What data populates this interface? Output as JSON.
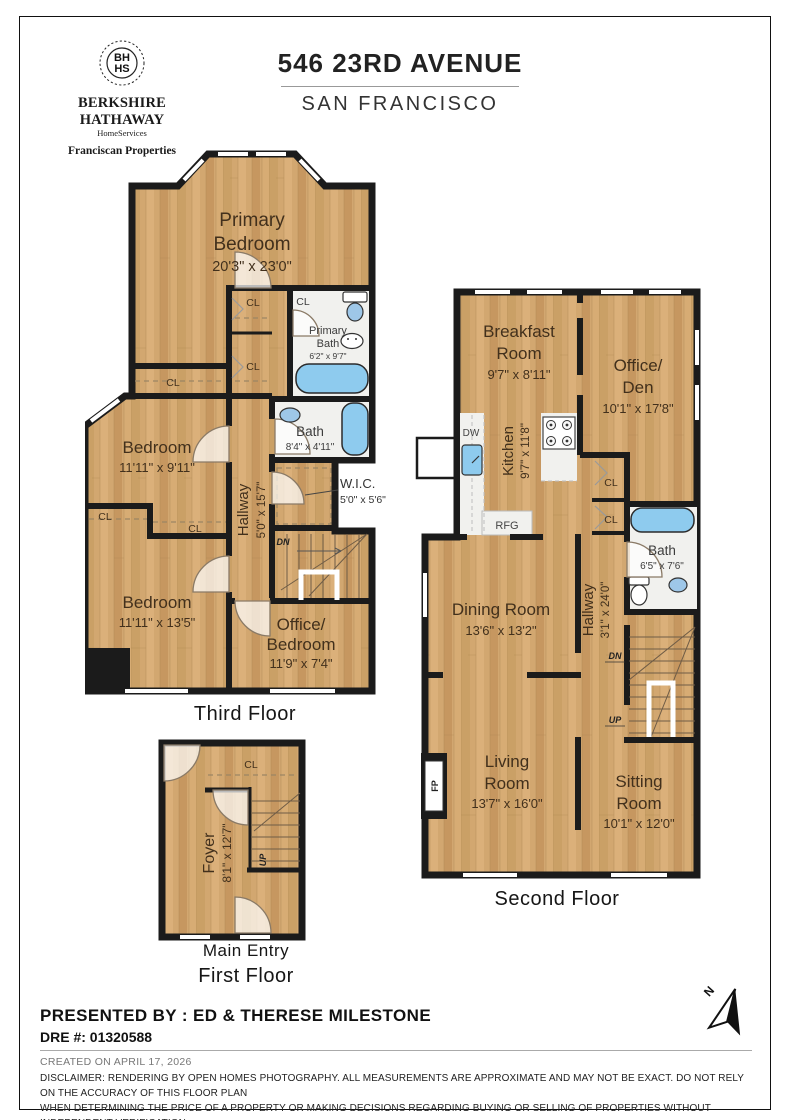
{
  "header": {
    "address": "546 23RD AVENUE",
    "city": "SAN FRANCISCO"
  },
  "brand": {
    "monogram_top": "BH",
    "monogram_bottom": "HS",
    "name": "BERKSHIRE HATHAWAY",
    "services": "HomeServices",
    "division": "Franciscan Properties"
  },
  "floor3": {
    "caption": "Third Floor",
    "primary_bedroom": {
      "l1": "Primary",
      "l2": "Bedroom",
      "dims": "20'3\" x 23'0\""
    },
    "primary_bath": {
      "l1": "Primary",
      "l2": "Bath",
      "dims": "6'2\" x 9'7\""
    },
    "bath": {
      "l1": "Bath",
      "dims": "8'4\" x 4'11\""
    },
    "bedroom_upper": {
      "l1": "Bedroom",
      "dims": "11'11\" x 9'11\""
    },
    "bedroom_lower": {
      "l1": "Bedroom",
      "dims": "11'11\" x 13'5\""
    },
    "office_bedroom": {
      "l1": "Office/",
      "l2": "Bedroom",
      "dims": "11'9\" x 7'4\""
    },
    "wic": {
      "l1": "W.I.C.",
      "dims": "5'0\" x 5'6\""
    },
    "hallway": {
      "l1": "Hallway",
      "dims": "5'0\" x 15'7\""
    }
  },
  "floor2": {
    "caption": "Second Floor",
    "breakfast": {
      "l1": "Breakfast",
      "l2": "Room",
      "dims": "9'7\" x 8'11\""
    },
    "office_den": {
      "l1": "Office/",
      "l2": "Den",
      "dims": "10'1\" x 17'8\""
    },
    "kitchen": {
      "l1": "Kitchen",
      "dims": "9'7\" x 11'8\""
    },
    "bath": {
      "l1": "Bath",
      "dims": "6'5\" x 7'6\""
    },
    "dining": {
      "l1": "Dining Room",
      "dims": "13'6\" x 13'2\""
    },
    "hallway": {
      "l1": "Hallway",
      "dims": "3'1\" x 24'0\""
    },
    "living": {
      "l1": "Living",
      "l2": "Room",
      "dims": "13'7\" x 16'0\""
    },
    "sitting": {
      "l1": "Sitting",
      "l2": "Room",
      "dims": "10'1\" x 12'0\""
    }
  },
  "floor1": {
    "caption_entry": "Main Entry",
    "caption": "First Floor",
    "foyer": {
      "l1": "Foyer",
      "dims": "8'1\" x 12'7\""
    }
  },
  "tags": {
    "cl": "CL",
    "dn": "DN",
    "up": "UP",
    "dw": "DW",
    "rfg": "RFG",
    "fp": "FP",
    "north": "N"
  },
  "footer": {
    "presented_by": "PRESENTED BY : ED & THERESE MILESTONE",
    "dre": "DRE #: 01320588",
    "created": "CREATED ON APRIL 17, 2026",
    "disclaimer_1": "DISCLAIMER: RENDERING BY OPEN HOMES PHOTOGRAPHY. ALL MEASUREMENTS ARE APPROXIMATE AND MAY NOT BE EXACT. DO NOT RELY ON THE ACCURACY OF THIS FLOOR PLAN",
    "disclaimer_2": "WHEN DETERMINING THE PRICE OF A PROPERTY OR MAKING DECISIONS REGARDING BUYING OR SELLING OF PROPERTIES WITHOUT INDEPENDENT VERIFICATION."
  },
  "colors": {
    "wood": "#d2a770",
    "wall": "#1b1b1b",
    "tub_blue": "#8ecbee",
    "room_text": "#42301c",
    "white_floor": "#f1f1ee"
  }
}
